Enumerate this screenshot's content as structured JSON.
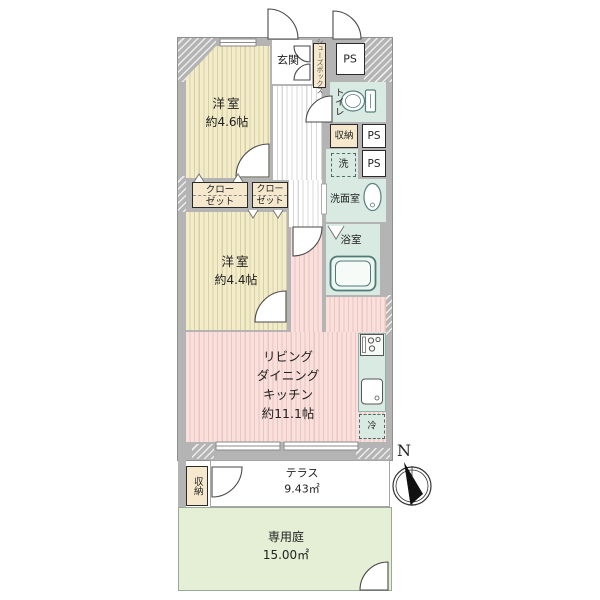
{
  "plan": {
    "rooms": {
      "bedroom1": {
        "name": "洋室",
        "size": "約4.6帖"
      },
      "bedroom2": {
        "name": "洋室",
        "size": "約4.4帖"
      },
      "ldk": {
        "lines": [
          "リビング",
          "ダイニング",
          "キッチン",
          "約11.1帖"
        ]
      },
      "entrance": {
        "label": "玄関"
      },
      "shoebox": {
        "label": "シューズボックス"
      },
      "toilet": {
        "label": "トイレ"
      },
      "washroom": {
        "label": "洗面室"
      },
      "laundry": {
        "label": "洗"
      },
      "bath": {
        "label": "浴室"
      },
      "storage_mid": {
        "label": "収納"
      },
      "storage_terrace": {
        "label": "収納"
      },
      "closet1": {
        "line1": "クロー",
        "line2": "ゼット"
      },
      "closet2": {
        "line1": "クロー",
        "line2": "ゼット"
      },
      "ps1": {
        "label": "PS"
      },
      "ps2": {
        "label": "PS"
      },
      "ps3": {
        "label": "PS"
      },
      "fridge": {
        "label": "冷"
      },
      "terrace": {
        "label": "テラス",
        "area": "9.43㎡"
      },
      "garden": {
        "label": "専用庭",
        "area": "15.00㎡"
      }
    },
    "compass": {
      "label": "N"
    },
    "colors": {
      "wall": "#b4b4b4",
      "bedroom_fill": "#f3ecca",
      "living_fill": "#f9e0dc",
      "wet_area_fill": "#d9eae3",
      "closet_fill": "#f5e8cd",
      "garden_fill": "#e4efd6",
      "fixture_stroke": "#56807c"
    }
  }
}
